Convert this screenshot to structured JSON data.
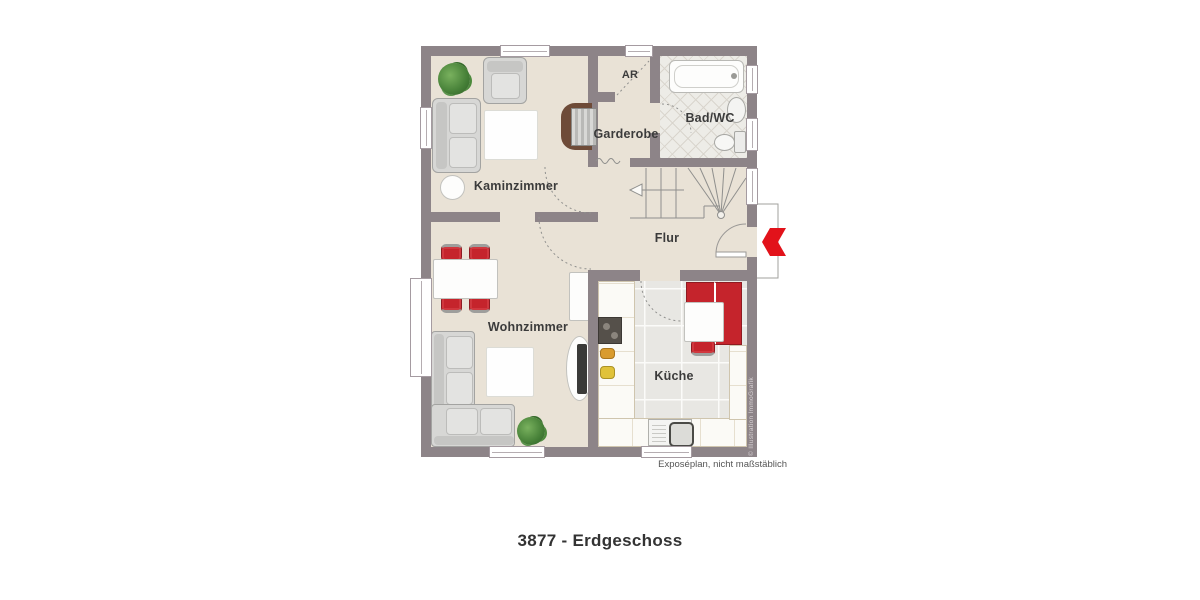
{
  "meta": {
    "caption": "3877 - Erdgeschoss",
    "disclaimer": "Exposéplan, nicht maßstäblich",
    "watermark": "© Illustration ImmoGrafik"
  },
  "rooms": {
    "kaminzimmer": "Kaminzimmer",
    "garderobe": "Garderobe",
    "ar": "AR",
    "bad_wc": "Bad/WC",
    "flur": "Flur",
    "wohnzimmer": "Wohnzimmer",
    "kueche": "Küche"
  },
  "colors": {
    "wall": "#8d8488",
    "floor": "#e9e2d6",
    "kitchen_floor": "#e8e7e3",
    "bath_floor": "#edece7",
    "furniture_red": "#c5242c",
    "entrance_arrow_red": "#e2121a",
    "label_text": "#3b3b3b"
  }
}
